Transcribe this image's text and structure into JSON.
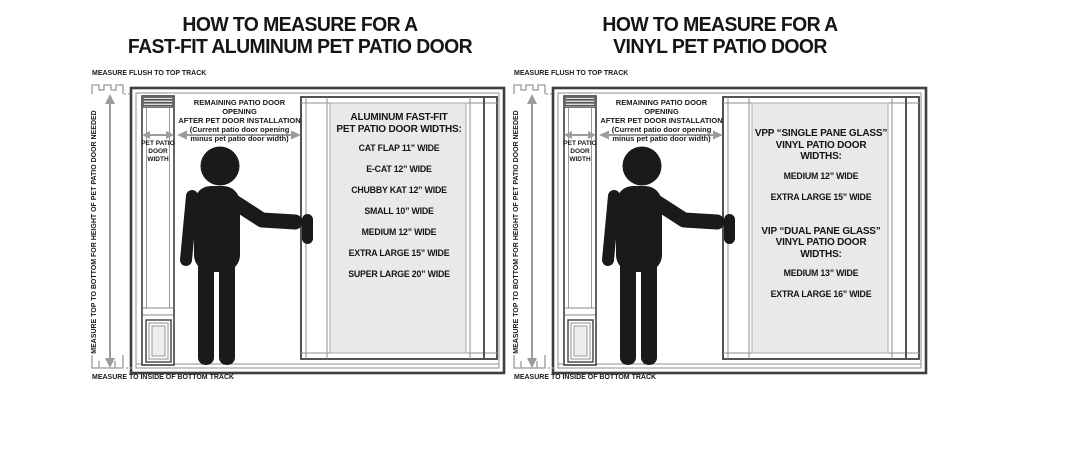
{
  "page": {
    "background": "#ffffff",
    "colors": {
      "line": "#3f3f3f",
      "frame_gray": "#8f8f8f",
      "arrow": "#9c9c9c",
      "glass": "#e9e9e9",
      "text": "#111111",
      "silhouette": "#1a1a1a"
    }
  },
  "diagrams": [
    {
      "id": "aluminum-fast-fit",
      "title_line1": "HOW TO MEASURE FOR A",
      "title_line2": "FAST-FIT ALUMINUM PET PATIO DOOR",
      "top_track_label": "MEASURE FLUSH TO TOP TRACK",
      "bottom_track_label": "MEASURE TO INSIDE OF BOTTOM TRACK",
      "height_arrow_label": "MEASURE TOP TO BOTTOM FOR HEIGHT OF PET PATIO DOOR NEEDED",
      "pet_door_width_label": "PET PATIO DOOR WIDTH",
      "opening_note_line1": "REMAINING PATIO DOOR OPENING",
      "opening_note_line2": "AFTER PET DOOR INSTALLATION",
      "opening_note_line3": "(Current patio door opening",
      "opening_note_line4": "minus pet patio door width)",
      "glass_sections": [
        {
          "heading_line1": "ALUMINUM FAST-FIT",
          "heading_line2": "PET PATIO DOOR WIDTHS:",
          "items": [
            "CAT FLAP 11” WIDE",
            "E-CAT 12” WIDE",
            "CHUBBY KAT 12” WIDE",
            "SMALL 10” WIDE",
            "MEDIUM 12” WIDE",
            "EXTRA LARGE 15” WIDE",
            "SUPER LARGE 20” WIDE"
          ]
        }
      ]
    },
    {
      "id": "vinyl",
      "title_line1": "HOW TO MEASURE FOR A",
      "title_line2": "VINYL PET PATIO DOOR",
      "top_track_label": "MEASURE FLUSH TO TOP TRACK",
      "bottom_track_label": "MEASURE TO INSIDE OF BOTTOM TRACK",
      "height_arrow_label": "MEASURE TOP TO BOTTOM FOR HEIGHT OF PET PATIO DOOR NEEDED",
      "pet_door_width_label": "PET PATIO DOOR WIDTH",
      "opening_note_line1": "REMAINING PATIO DOOR OPENING",
      "opening_note_line2": "AFTER PET DOOR INSTALLATION",
      "opening_note_line3": "(Current patio door opening",
      "opening_note_line4": "minus pet patio door width)",
      "glass_sections": [
        {
          "heading_line1": "VPP “SINGLE PANE GLASS”",
          "heading_line2": "VINYL PATIO DOOR WIDTHS:",
          "items": [
            "MEDIUM 12” WIDE",
            "EXTRA LARGE 15” WIDE"
          ]
        },
        {
          "heading_line1": "VIP “DUAL PANE GLASS”",
          "heading_line2": "VINYL PATIO DOOR WIDTHS:",
          "items": [
            "MEDIUM 13” WIDE",
            "EXTRA LARGE 16” WIDE"
          ]
        }
      ]
    }
  ]
}
